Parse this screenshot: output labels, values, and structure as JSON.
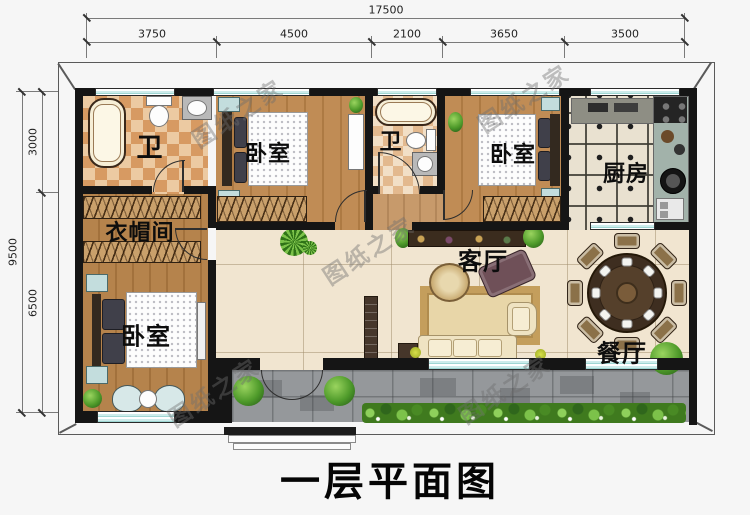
{
  "title": {
    "text": "一层平面图"
  },
  "watermark": {
    "text": "图纸之家"
  },
  "dimensions": {
    "top": {
      "total": "17500",
      "segments": [
        "3750",
        "4500",
        "2100",
        "3650",
        "3500"
      ]
    },
    "left": {
      "total": "9500",
      "segments": [
        "3000",
        "6500"
      ]
    }
  },
  "rooms": {
    "bathroom_left": "卫",
    "bedroom_top": "卧室",
    "bathroom_middle": "卫",
    "bedroom_right": "卧室",
    "kitchen": "厨房",
    "cloakroom": "衣帽间",
    "living_room": "客厅",
    "bedroom_bottom": "卧室",
    "dining_room": "餐厅"
  },
  "colors": {
    "wall": "#151515",
    "window_glass": "#cdeceb",
    "wood_floor": "#bb8850",
    "living_tile": "#f1e5d0",
    "bath_tile": "#d79a62",
    "patio_stone": "#95989b",
    "greenery": "#4e9a2a",
    "dimension_text": "#222222"
  }
}
